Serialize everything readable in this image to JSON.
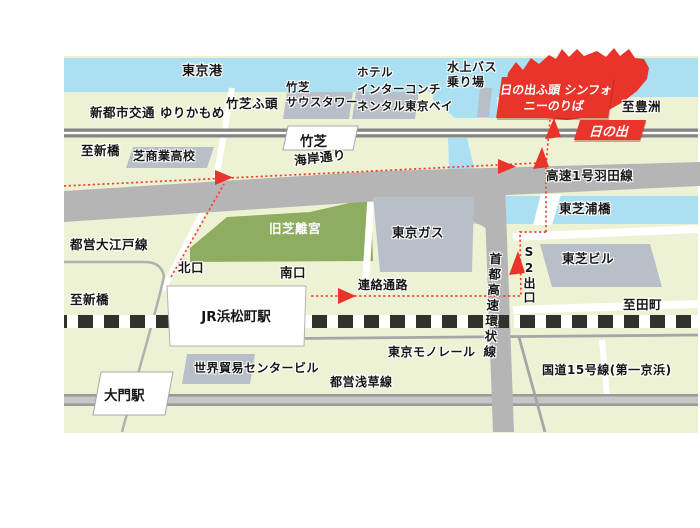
{
  "colors": {
    "land": "#eef2d4",
    "water": "#abdff2",
    "road": "#b5b5b5",
    "building": "#b9bfc8",
    "park": "#8fad60",
    "accent_red": "#e8342a",
    "route_red": "#ef4433",
    "rail_black": "#33312b"
  },
  "labels": {
    "tokyo_bay": "東京港",
    "yurikamome": "新都市交通 ゆりかもめ",
    "takeshiba_pier": "竹芝ふ頭",
    "takeshiba_south_tower": "竹芝\nサウスタワー",
    "hotel_intercontinental": "ホテル\nインターコンチ\nネンタル東京ベイ",
    "water_bus_stop": "水上バス\n乗り場",
    "hinode_pier_symphony": "日の出ふ頭\nシンフォニーのりば",
    "to_toyosu": "至豊洲",
    "hinode_station": "日の出",
    "takeshiba_station": "竹芝",
    "to_shimbashi": "至新橋",
    "shiba_commercial_hs": "芝商業高校",
    "kaigan_dori": "海岸通り",
    "haneda_expressway": "高速1号羽田線",
    "higashi_shibaura_bridge": "東芝浦橋",
    "oedo_line": "都営大江戸線",
    "kyu_shiba_rikyu": "旧芝離宮",
    "tokyo_gas": "東京ガス",
    "north_exit": "北口",
    "south_exit": "南口",
    "renraku_tsuro": "連絡通路",
    "s2_exit": "S2出口",
    "toshiba_building": "東芝ビル",
    "shuto_expressway": "首都高速環状線",
    "jr_hamamatsucho": "JR浜松町駅",
    "to_tamachi": "至田町",
    "world_trade_center": "世界貿易センタービル",
    "tokyo_monorail": "東京モノレール",
    "asakusa_line": "都営浅草線",
    "route15": "国道15号線(第一京浜)",
    "daimon_station": "大門駅"
  }
}
